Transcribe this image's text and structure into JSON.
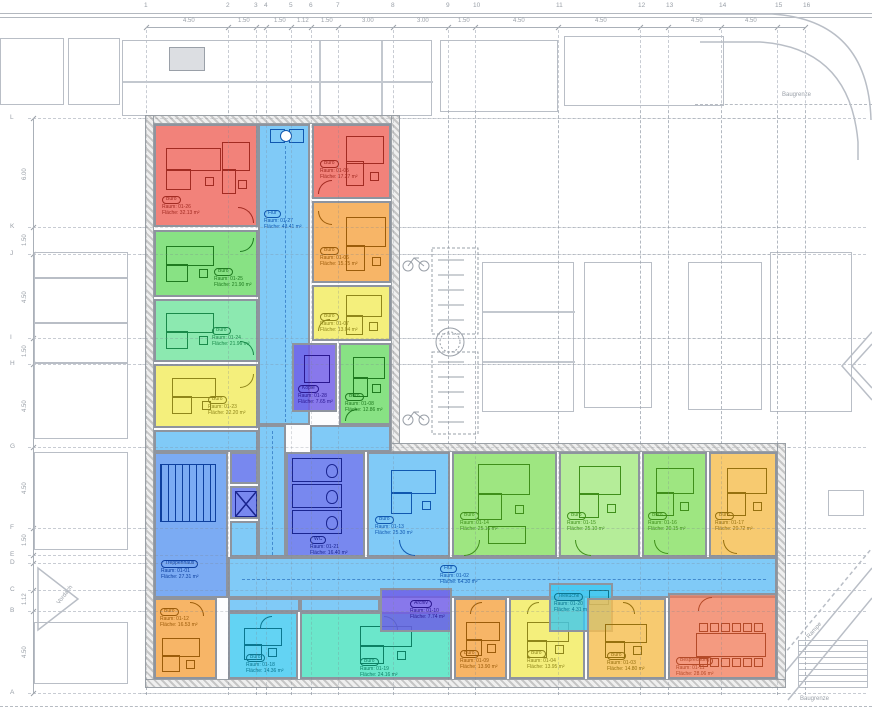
{
  "palette": {
    "red": {
      "fill": "rgba(238,95,85,0.78)",
      "ink": "#a22b22"
    },
    "salmon": {
      "fill": "rgba(240,120,85,0.75)",
      "ink": "#b44a28"
    },
    "green": {
      "fill": "rgba(90,215,85,0.72)",
      "ink": "#1f7a1f"
    },
    "mint": {
      "fill": "rgba(95,225,145,0.72)",
      "ink": "#1a8a4a"
    },
    "lime": {
      "fill": "rgba(120,220,80,0.72)",
      "ink": "#3f8f1a"
    },
    "lime2": {
      "fill": "rgba(150,230,110,0.70)",
      "ink": "#3f8f1a"
    },
    "yellow": {
      "fill": "rgba(242,235,95,0.82)",
      "ink": "#8f861a"
    },
    "amber": {
      "fill": "rgba(245,190,80,0.82)",
      "ink": "#96700e"
    },
    "orange": {
      "fill": "rgba(245,160,60,0.78)",
      "ink": "#9c5c0a"
    },
    "lightblue": {
      "fill": "rgba(100,190,245,0.82)",
      "ink": "#1058b0"
    },
    "medblue": {
      "fill": "rgba(90,150,240,0.80)",
      "ink": "#0d3f9e"
    },
    "indigo": {
      "fill": "rgba(90,110,235,0.82)",
      "ink": "#1a2590"
    },
    "purple": {
      "fill": "rgba(110,90,230,0.82)",
      "ink": "#2a1790"
    },
    "cyan": {
      "fill": "rgba(60,200,240,0.80)",
      "ink": "#0a7690"
    },
    "turquoise": {
      "fill": "rgba(70,225,190,0.80)",
      "ink": "#0c8064"
    }
  },
  "site": {
    "baugrenze_top": "Baugrenze",
    "baugrenze_bottom": "Baugrenze",
    "vordach": "Vordach",
    "rampe": "Rampe"
  },
  "grid": {
    "columns": [
      {
        "n": "1",
        "x": 146
      },
      {
        "n": "2",
        "x": 228
      },
      {
        "n": "3",
        "x": 256
      },
      {
        "n": "4",
        "x": 266
      },
      {
        "n": "5",
        "x": 291
      },
      {
        "n": "6",
        "x": 311
      },
      {
        "n": "7",
        "x": 338
      },
      {
        "n": "8",
        "x": 393
      },
      {
        "n": "9",
        "x": 448
      },
      {
        "n": "10",
        "x": 475
      },
      {
        "n": "11",
        "x": 558
      },
      {
        "n": "12",
        "x": 640
      },
      {
        "n": "13",
        "x": 668
      },
      {
        "n": "14",
        "x": 721
      },
      {
        "n": "15",
        "x": 777
      },
      {
        "n": "16",
        "x": 805
      }
    ],
    "col_dims": [
      {
        "t": "4.50",
        "x": 183
      },
      {
        "t": "1.50",
        "x": 238
      },
      {
        "t": "1.50",
        "x": 274
      },
      {
        "t": "1.12",
        "x": 297
      },
      {
        "t": "1.50",
        "x": 321
      },
      {
        "t": "3.00",
        "x": 362
      },
      {
        "t": "3.00",
        "x": 417
      },
      {
        "t": "1.50",
        "x": 458
      },
      {
        "t": "4.50",
        "x": 513
      },
      {
        "t": "4.50",
        "x": 595
      },
      {
        "t": "4.50",
        "x": 691
      },
      {
        "t": "4.50",
        "x": 745
      }
    ],
    "rows": [
      {
        "n": "L",
        "y": 118
      },
      {
        "n": "K",
        "y": 227
      },
      {
        "n": "J",
        "y": 254
      },
      {
        "n": "I",
        "y": 338
      },
      {
        "n": "H",
        "y": 364
      },
      {
        "n": "G",
        "y": 447
      },
      {
        "n": "F",
        "y": 528
      },
      {
        "n": "E",
        "y": 555
      },
      {
        "n": "D",
        "y": 563
      },
      {
        "n": "C",
        "y": 590
      },
      {
        "n": "B",
        "y": 611
      },
      {
        "n": "A",
        "y": 693
      }
    ],
    "row_dims": [
      {
        "t": "6.00",
        "y": 180
      },
      {
        "t": "1.50",
        "y": 246
      },
      {
        "t": "4.50",
        "y": 303
      },
      {
        "t": "1.50",
        "y": 357
      },
      {
        "t": "4.50",
        "y": 412
      },
      {
        "t": "4.50",
        "y": 494
      },
      {
        "t": "1.50",
        "y": 546
      },
      {
        "t": "1.12",
        "y": 605
      },
      {
        "t": "4.50",
        "y": 658
      }
    ]
  },
  "rooms": [
    {
      "id": "01-26",
      "stamp": "Büro",
      "no": "Raum: 01-26",
      "area": "Fläche: 32.13 m²",
      "color": "red",
      "rect": [
        154,
        124,
        104,
        103
      ],
      "label": [
        6,
        70
      ],
      "door": [
        82,
        81,
        16,
        "ne"
      ],
      "furn": [
        {
          "t": "desk",
          "x": 10,
          "y": 22,
          "w": 55,
          "h": 42
        },
        {
          "t": "desk",
          "x": 66,
          "y": 16,
          "w": 28,
          "h": 52
        }
      ]
    },
    {
      "id": "01-25",
      "stamp": "Büro",
      "no": "Raum: 01-25",
      "area": "Fläche: 21.90 m²",
      "color": "green",
      "rect": [
        154,
        230,
        104,
        67
      ],
      "label": [
        58,
        36
      ],
      "door": [
        84,
        6,
        14,
        "se"
      ],
      "furn": [
        {
          "t": "desk",
          "x": 10,
          "y": 14,
          "w": 48,
          "h": 36
        }
      ]
    },
    {
      "id": "01-24",
      "stamp": "Büro",
      "no": "Raum: 01-24",
      "area": "Fläche: 21.96 m²",
      "color": "mint",
      "rect": [
        154,
        299,
        104,
        63
      ],
      "label": [
        56,
        26
      ],
      "door": [
        84,
        40,
        14,
        "ne"
      ],
      "furn": [
        {
          "t": "desk",
          "x": 10,
          "y": 12,
          "w": 48,
          "h": 36
        }
      ]
    },
    {
      "id": "01-23",
      "stamp": "Büro",
      "no": "Raum: 01-23",
      "area": "Fläche: 22.20 m²",
      "color": "yellow",
      "rect": [
        154,
        364,
        104,
        64
      ],
      "label": [
        52,
        30
      ],
      "door": [
        84,
        8,
        14,
        "se"
      ],
      "furn": [
        {
          "t": "desk",
          "x": 16,
          "y": 12,
          "w": 44,
          "h": 36
        }
      ]
    },
    {
      "id": "01-27",
      "stamp": "Flur",
      "no": "Raum: 01-27",
      "area": "Fläche: 43.41 m²",
      "color": "lightblue",
      "rect": [
        258,
        124,
        52,
        301
      ],
      "label": [
        4,
        84
      ],
      "furn": [
        {
          "t": "rect",
          "x": 10,
          "y": 3,
          "w": 13,
          "h": 12
        },
        {
          "t": "rect",
          "x": 29,
          "y": 3,
          "w": 13,
          "h": 12
        },
        {
          "t": "circ",
          "x": 20,
          "y": 4,
          "w": 10,
          "h": 10
        },
        {
          "t": "dashv",
          "x": 25,
          "y": 20,
          "h": 276
        }
      ]
    },
    {
      "id": "flur-verb",
      "stamp": null,
      "no": null,
      "area": null,
      "color": "lightblue",
      "rect": [
        258,
        425,
        28,
        132
      ],
      "label": null,
      "furn": [
        {
          "t": "dashv",
          "x": 12,
          "y": 4,
          "h": 124
        }
      ]
    },
    {
      "id": "flur-junction",
      "stamp": null,
      "no": null,
      "area": null,
      "color": "lightblue",
      "rect": [
        310,
        425,
        81,
        27
      ],
      "label": null,
      "furn": []
    },
    {
      "id": "eingang",
      "stamp": null,
      "no": null,
      "area": null,
      "color": "lightblue",
      "rect": [
        154,
        430,
        104,
        22
      ],
      "label": null,
      "furn": []
    },
    {
      "id": "01-05",
      "stamp": "Büro",
      "no": "Raum: 01-05",
      "area": "Fläche: 17.27 m²",
      "color": "red",
      "rect": [
        312,
        124,
        79,
        75
      ],
      "label": [
        6,
        34
      ],
      "door": [
        4,
        54,
        14,
        "nw"
      ],
      "furn": [
        {
          "t": "desk",
          "x": 32,
          "y": 10,
          "w": 38,
          "h": 50
        }
      ]
    },
    {
      "id": "01-06",
      "stamp": "Büro",
      "no": "Raum: 01-06",
      "area": "Fläche: 15.75 m²",
      "color": "orange",
      "rect": [
        312,
        201,
        79,
        82
      ],
      "label": [
        6,
        44
      ],
      "door": [
        4,
        8,
        14,
        "sw"
      ],
      "furn": [
        {
          "t": "desk",
          "x": 32,
          "y": 14,
          "w": 40,
          "h": 54
        }
      ]
    },
    {
      "id": "01-07",
      "stamp": "Büro",
      "no": "Raum: 01-07",
      "area": "Fläche: 13.04 m²",
      "color": "yellow",
      "rect": [
        312,
        285,
        79,
        56
      ],
      "label": [
        6,
        26
      ],
      "door": [
        4,
        32,
        12,
        "nw"
      ],
      "furn": [
        {
          "t": "desk",
          "x": 32,
          "y": 8,
          "w": 36,
          "h": 40
        }
      ]
    },
    {
      "id": "01-28",
      "stamp": "Kopie",
      "no": "Raum: 01-28",
      "area": "Fläche: 7.65 m²",
      "color": "purple",
      "rect": [
        292,
        343,
        45,
        69
      ],
      "label": [
        4,
        40
      ],
      "furn": [
        {
          "t": "rect",
          "x": 10,
          "y": 10,
          "w": 24,
          "h": 26
        }
      ]
    },
    {
      "id": "01-08",
      "stamp": "Büro",
      "no": "Raum: 01-08",
      "area": "Fläche: 12.86 m²",
      "color": "green",
      "rect": [
        339,
        343,
        52,
        82
      ],
      "label": [
        4,
        48
      ],
      "door": [
        4,
        64,
        12,
        "nw"
      ],
      "furn": [
        {
          "t": "desk",
          "x": 12,
          "y": 12,
          "w": 32,
          "h": 40
        }
      ]
    },
    {
      "id": "01-01",
      "stamp": "Treppenhaus",
      "no": "Raum: 01-01",
      "area": "Fläche: 27.31 m²",
      "color": "medblue",
      "rect": [
        154,
        452,
        74,
        146
      ],
      "label": [
        5,
        106
      ],
      "furn": [
        {
          "t": "stairs",
          "x": 4,
          "y": 10,
          "w": 54,
          "h": 56
        }
      ]
    },
    {
      "id": "technik",
      "stamp": null,
      "no": null,
      "area": null,
      "color": "indigo",
      "rect": [
        230,
        452,
        28,
        32
      ],
      "label": null,
      "furn": []
    },
    {
      "id": "aufzug",
      "stamp": null,
      "no": null,
      "area": null,
      "color": "indigo",
      "rect": [
        230,
        486,
        28,
        33
      ],
      "label": null,
      "furn": [
        {
          "t": "xbox",
          "x": 3,
          "y": 3,
          "w": 20,
          "h": 24
        }
      ]
    },
    {
      "id": "flur-lift",
      "stamp": null,
      "no": null,
      "area": null,
      "color": "lightblue",
      "rect": [
        230,
        521,
        28,
        36
      ],
      "label": null,
      "furn": []
    },
    {
      "id": "01-21",
      "stamp": "WC",
      "no": "Raum: 01-21",
      "area": "Fläche: 16.40 m²",
      "color": "indigo",
      "rect": [
        286,
        452,
        79,
        105
      ],
      "label": [
        22,
        82
      ],
      "furn": [
        {
          "t": "wc",
          "x": 4,
          "y": 4,
          "w": 48,
          "h": 74
        }
      ]
    },
    {
      "id": "01-13",
      "stamp": "Büro",
      "no": "Raum: 01-13",
      "area": "Fläche: 25.30 m²",
      "color": "lightblue",
      "rect": [
        367,
        452,
        83,
        105
      ],
      "label": [
        6,
        62
      ],
      "door": [
        30,
        86,
        16,
        "sw"
      ],
      "furn": [
        {
          "t": "desk",
          "x": 22,
          "y": 16,
          "w": 45,
          "h": 44
        }
      ]
    },
    {
      "id": "01-14",
      "stamp": "Büro",
      "no": "Raum: 01-14",
      "area": "Fläche: 25.16 m²",
      "color": "lime",
      "rect": [
        452,
        452,
        105,
        105
      ],
      "label": [
        6,
        58
      ],
      "door": [
        10,
        86,
        16,
        "se"
      ],
      "furn": [
        {
          "t": "desk",
          "x": 24,
          "y": 10,
          "w": 52,
          "h": 56
        },
        {
          "t": "rect",
          "x": 34,
          "y": 72,
          "w": 36,
          "h": 16
        }
      ]
    },
    {
      "id": "01-15",
      "stamp": "Büro",
      "no": "Raum: 01-15",
      "area": "Fläche: 25.10 m²",
      "color": "lime2",
      "rect": [
        559,
        452,
        81,
        105
      ],
      "label": [
        6,
        58
      ],
      "door": [
        14,
        86,
        16,
        "sw"
      ],
      "furn": [
        {
          "t": "desk",
          "x": 18,
          "y": 12,
          "w": 42,
          "h": 52
        }
      ]
    },
    {
      "id": "01-16",
      "stamp": "Büro",
      "no": "Raum: 01-16",
      "area": "Fläche: 20.15 m²",
      "color": "lime",
      "rect": [
        642,
        452,
        65,
        105
      ],
      "label": [
        4,
        58
      ],
      "door": [
        10,
        86,
        14,
        "sw"
      ],
      "furn": [
        {
          "t": "desk",
          "x": 12,
          "y": 14,
          "w": 38,
          "h": 48
        }
      ]
    },
    {
      "id": "01-17",
      "stamp": "Büro",
      "no": "Raum: 01-17",
      "area": "Fläche: 20.72 m²",
      "color": "amber",
      "rect": [
        709,
        452,
        68,
        105
      ],
      "label": [
        4,
        58
      ],
      "door": [
        12,
        86,
        14,
        "sw"
      ],
      "furn": [
        {
          "t": "desk",
          "x": 16,
          "y": 14,
          "w": 40,
          "h": 48
        }
      ]
    },
    {
      "id": "01-02",
      "stamp": "Flur",
      "no": "Raum: 01-02",
      "area": "Fläche: 64.30 m²",
      "color": "lightblue",
      "rect": [
        228,
        557,
        549,
        41
      ],
      "label": [
        210,
        6
      ],
      "furn": [
        {
          "t": "dashh",
          "x": 12,
          "y": 20,
          "w": 524
        }
      ]
    },
    {
      "id": "flur-jog1",
      "stamp": null,
      "no": null,
      "area": null,
      "color": "lightblue",
      "rect": [
        228,
        598,
        72,
        14
      ],
      "label": null,
      "furn": []
    },
    {
      "id": "flur-jog2",
      "stamp": null,
      "no": null,
      "area": null,
      "color": "lightblue",
      "rect": [
        300,
        598,
        80,
        14
      ],
      "label": null,
      "furn": []
    },
    {
      "id": "01-12",
      "stamp": "Büro",
      "no": "Raum: 01-12",
      "area": "Fläche: 16.53 m²",
      "color": "orange",
      "rect": [
        154,
        598,
        63,
        81
      ],
      "label": [
        4,
        8
      ],
      "door": [
        34,
        2,
        14,
        "ne"
      ],
      "furn": [
        {
          "t": "desk",
          "x": 6,
          "y": 38,
          "w": 38,
          "h": 34
        }
      ]
    },
    {
      "id": "01-18",
      "stamp": "Büro",
      "no": "Raum: 01-18",
      "area": "Fläche: 14.36 m²",
      "color": "cyan",
      "rect": [
        228,
        612,
        70,
        67
      ],
      "label": [
        16,
        40
      ],
      "door": [
        30,
        2,
        12,
        "nw"
      ],
      "furn": [
        {
          "t": "desk",
          "x": 14,
          "y": 14,
          "w": 38,
          "h": 32
        }
      ]
    },
    {
      "id": "01-19",
      "stamp": "Büro",
      "no": "Raum: 01-19",
      "area": "Fläche: 24.16 m²",
      "color": "turquoise",
      "rect": [
        300,
        612,
        152,
        67
      ],
      "label": [
        58,
        44
      ],
      "door": [
        82,
        2,
        14,
        "ne"
      ],
      "furn": [
        {
          "t": "desk",
          "x": 58,
          "y": 12,
          "w": 52,
          "h": 38
        }
      ]
    },
    {
      "id": "01-10",
      "stamp": "Archiv",
      "no": "Raum: 01-10",
      "area": "Fläche: 7.74 m²",
      "color": "purple",
      "rect": [
        380,
        588,
        72,
        44
      ],
      "label": [
        28,
        10
      ],
      "furn": []
    },
    {
      "id": "01-09",
      "stamp": "Büro",
      "no": "Raum: 01-09",
      "area": "Fläche: 13.90 m²",
      "color": "orange",
      "rect": [
        454,
        598,
        53,
        81
      ],
      "label": [
        4,
        50
      ],
      "door": [
        14,
        2,
        12,
        "nw"
      ],
      "furn": [
        {
          "t": "desk",
          "x": 10,
          "y": 22,
          "w": 34,
          "h": 34
        }
      ]
    },
    {
      "id": "01-04",
      "stamp": "Büro",
      "no": "Raum: 01-04",
      "area": "Fläche: 13.95 m²",
      "color": "yellow",
      "rect": [
        509,
        598,
        76,
        81
      ],
      "label": [
        16,
        50
      ],
      "door": [
        16,
        2,
        12,
        "nw"
      ],
      "furn": [
        {
          "t": "desk",
          "x": 16,
          "y": 22,
          "w": 42,
          "h": 36
        }
      ]
    },
    {
      "id": "01-20",
      "stamp": "Teeküche",
      "no": "Raum: 01-20",
      "area": "Fläche: 4.31 m²",
      "color": "cyan",
      "rect": [
        549,
        583,
        64,
        49
      ],
      "label": [
        3,
        8
      ],
      "furn": [
        {
          "t": "rect",
          "x": 38,
          "y": 5,
          "w": 18,
          "h": 13
        }
      ]
    },
    {
      "id": "01-03",
      "stamp": "Büro",
      "no": "Raum: 01-03",
      "area": "Fläche: 14.80 m²",
      "color": "amber",
      "rect": [
        587,
        598,
        79,
        81
      ],
      "label": [
        18,
        52
      ],
      "door": [
        34,
        2,
        12,
        "ne"
      ],
      "furn": [
        {
          "t": "desk",
          "x": 16,
          "y": 24,
          "w": 42,
          "h": 34
        }
      ]
    },
    {
      "id": "01-11",
      "stamp": "Besprechung",
      "no": "Raum: 01-11",
      "area": "Fläche: 28.06 m²",
      "color": "salmon",
      "rect": [
        668,
        593,
        109,
        86
      ],
      "label": [
        6,
        62
      ],
      "door": [
        28,
        2,
        14,
        "nw"
      ],
      "furn": [
        {
          "t": "conf",
          "x": 26,
          "y": 38,
          "w": 70,
          "h": 24
        }
      ]
    }
  ]
}
